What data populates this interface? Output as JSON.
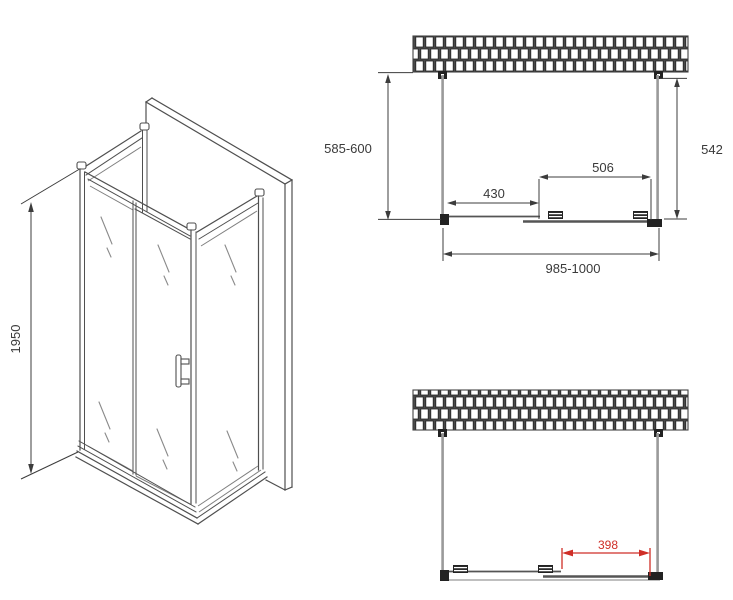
{
  "drawing": {
    "type": "shower-enclosure-technical-drawing",
    "colors": {
      "line": "#4f4f4f",
      "dimension_text": "#3a3a3a",
      "accent_red": "#cf2e27",
      "wall_line": "#9a9a9a",
      "hardware_black": "#222222",
      "background": "#ffffff"
    },
    "iso": {
      "height": "1950"
    },
    "plan": {
      "depth": "585-600",
      "inner_depth": "542",
      "door_width": "506",
      "door_offset": "430",
      "width": "985-1000"
    },
    "front": {
      "opening": "398"
    }
  }
}
